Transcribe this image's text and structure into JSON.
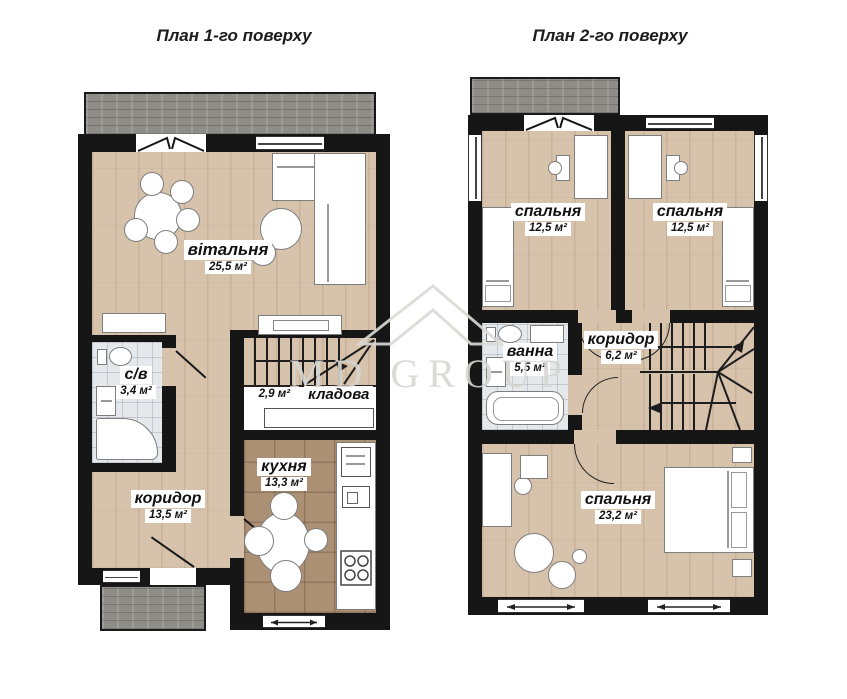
{
  "watermark": {
    "text": "MD GROUP"
  },
  "plans": [
    {
      "title": "План 1-го поверху",
      "rooms": {
        "living": {
          "name": "вітальня",
          "area": "25,5 м²"
        },
        "wc": {
          "name": "с/в",
          "area": "3,4 м²"
        },
        "storage": {
          "name": "кладова",
          "area": "2,9 м²"
        },
        "kitchen": {
          "name": "кухня",
          "area": "13,3 м²"
        },
        "corridor": {
          "name": "коридор",
          "area": "13,5 м²"
        }
      }
    },
    {
      "title": "План 2-го поверху",
      "rooms": {
        "bedroom1": {
          "name": "спальня",
          "area": "12,5 м²"
        },
        "bedroom2": {
          "name": "спальня",
          "area": "12,5 м²"
        },
        "bath": {
          "name": "ванна",
          "area": "5,5 м²"
        },
        "corridor": {
          "name": "коридор",
          "area": "6,2 м²"
        },
        "bedroom3": {
          "name": "спальня",
          "area": "23,2 м²"
        }
      }
    }
  ],
  "colors": {
    "wall": "#161616",
    "wood_floor": "#d7c3ac",
    "kitchen_tile": "#ac9074",
    "bath_tile": "#e5e9ec",
    "terrace": "#8f8d87",
    "watermark": "#d6d6d2"
  }
}
